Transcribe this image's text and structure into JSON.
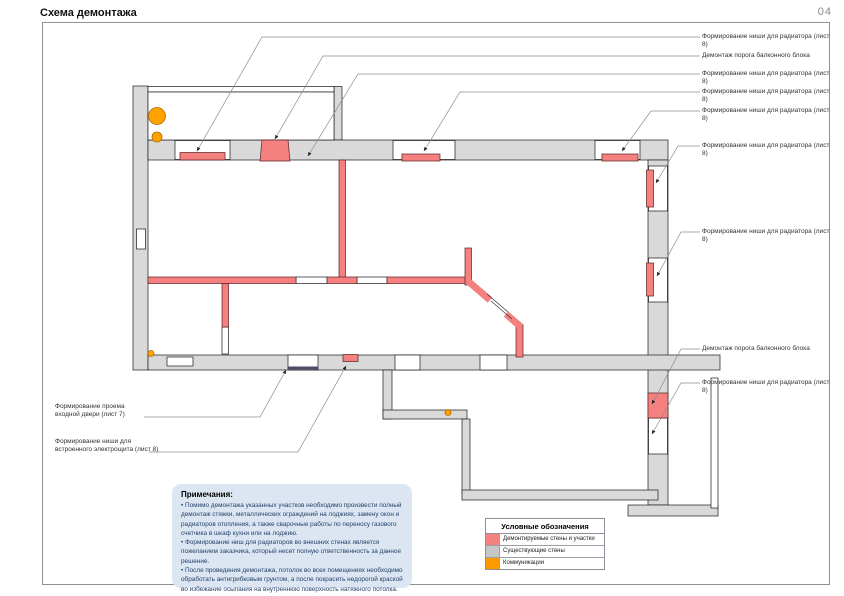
{
  "page": {
    "title": "Схема демонтажа",
    "number": "04"
  },
  "callouts": {
    "right": [
      {
        "text": "Формирование ниши для радиатора (лист 8)"
      },
      {
        "text": "Демонтаж порога балконного блока"
      },
      {
        "text": "Формирование ниши для радиатора (лист 8)"
      },
      {
        "text": "Формирование ниши для радиатора (лист 8)"
      },
      {
        "text": "Формирование ниши для радиатора (лист 8)"
      },
      {
        "text": "Формирование ниши для радиатора (лист 8)"
      },
      {
        "text": "Формирование ниши для радиатора (лист 8)"
      },
      {
        "text": "Демонтаж порога балконного блока"
      },
      {
        "text": "Формирование ниши для радиатора (лист 8)"
      }
    ],
    "left": [
      {
        "line1": "Формирование проема",
        "line2": "входной двери (лист 7)"
      },
      {
        "line1": "Формирование ниши для",
        "line2": "встроенного электрощита (лист 8)"
      }
    ]
  },
  "notes": {
    "title": "Примечания:",
    "items": [
      "• Помимо демонтажа указанных участков необходимо произвести полный демонтаж стяжки, металлических ограждений на лоджиях, замену окон и радиаторов отопления, а также сварочные работы по переносу газового счетчика в шкаф кухни или на лоджию.",
      "• Формирование ниш для радиаторов во внешних стенах является пожеланием заказчика, который несет полную ответственность за данное решение.",
      "• После проведения демонтажа, потолок во всех помещениях необходимо обработать антигрибковым грунтом, а после покрасить недорогой краской во избежание осыпания на внутреннюю поверхность натяжного потолка."
    ]
  },
  "legend": {
    "title": "Условные обозначения",
    "items": [
      {
        "label": "Демонтируемые стены и участки",
        "color": "#f4807f"
      },
      {
        "label": "Существующие стены",
        "color": "#c6c6c6"
      },
      {
        "label": "Коммуникации",
        "color": "#ff9900"
      }
    ]
  },
  "colors": {
    "demolished": "#f4807f",
    "existing_wall": "#d9d9d9",
    "communications": "#ffa200",
    "leader_line": "#8c8c8c"
  }
}
